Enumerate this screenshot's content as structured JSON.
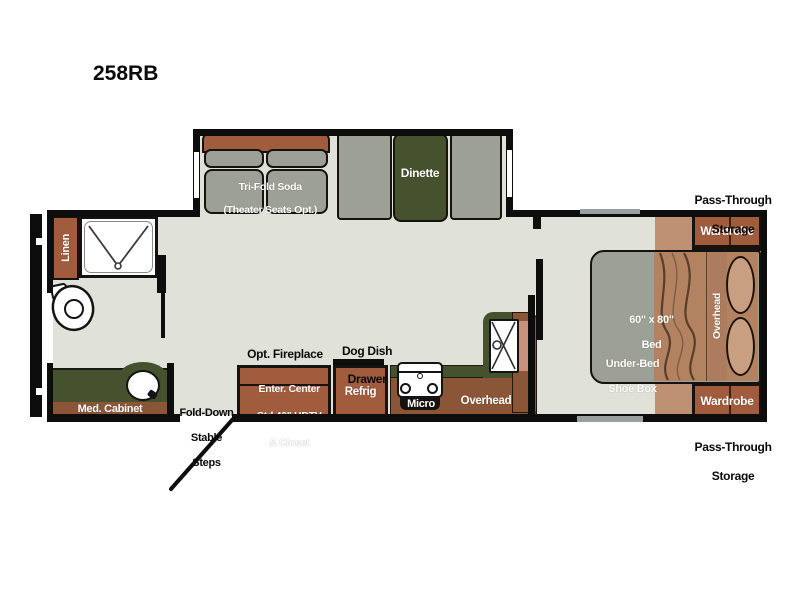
{
  "title": "258RB",
  "colors": {
    "wall": "#0d0d0d",
    "floor": "#e0e1d8",
    "carpet": "#bf9173",
    "wood": "#a05c3d",
    "wood_dark": "#8a5637",
    "counter_green": "#46522d",
    "furniture_gray": "#9da096",
    "blanket": "#b28261",
    "pillow": "#c99f82"
  },
  "plan": {
    "slideout": {
      "sofa_line1": "Tri-Fold Soda",
      "sofa_line2": "(Theater Seats Opt.)",
      "dinette": "Dinette"
    },
    "bathroom": {
      "linen": "Linen",
      "med_cabinet": "Med. Cabinet"
    },
    "entry": {
      "steps_line1": "Fold-Down",
      "steps_line2": "Stable",
      "steps_line3": "Steps"
    },
    "kitchen": {
      "opt_fireplace": "Opt. Fireplace",
      "enter_center_line1": "Enter. Center",
      "enter_center_line2": "Std 40\" HDTV",
      "enter_center_line3": "& Closet",
      "dog_dish_line1": "Dog Dish",
      "dog_dish_line2": "Drawer",
      "refrig": "Refrig",
      "micro": "Micro",
      "overhead": "Overhead"
    },
    "bedroom": {
      "bed_line1": "60\" x 80\"",
      "bed_line2": "Bed",
      "underbed_line1": "Under-Bed",
      "underbed_line2": "Shoe Box",
      "overhead": "Overhead",
      "wardrobe_top": "Wardrobe",
      "wardrobe_bottom": "Wardrobe",
      "pass_through_top_line1": "Pass-Through",
      "pass_through_top_line2": "Storage",
      "pass_through_bottom_line1": "Pass-Through",
      "pass_through_bottom_line2": "Storage"
    }
  }
}
